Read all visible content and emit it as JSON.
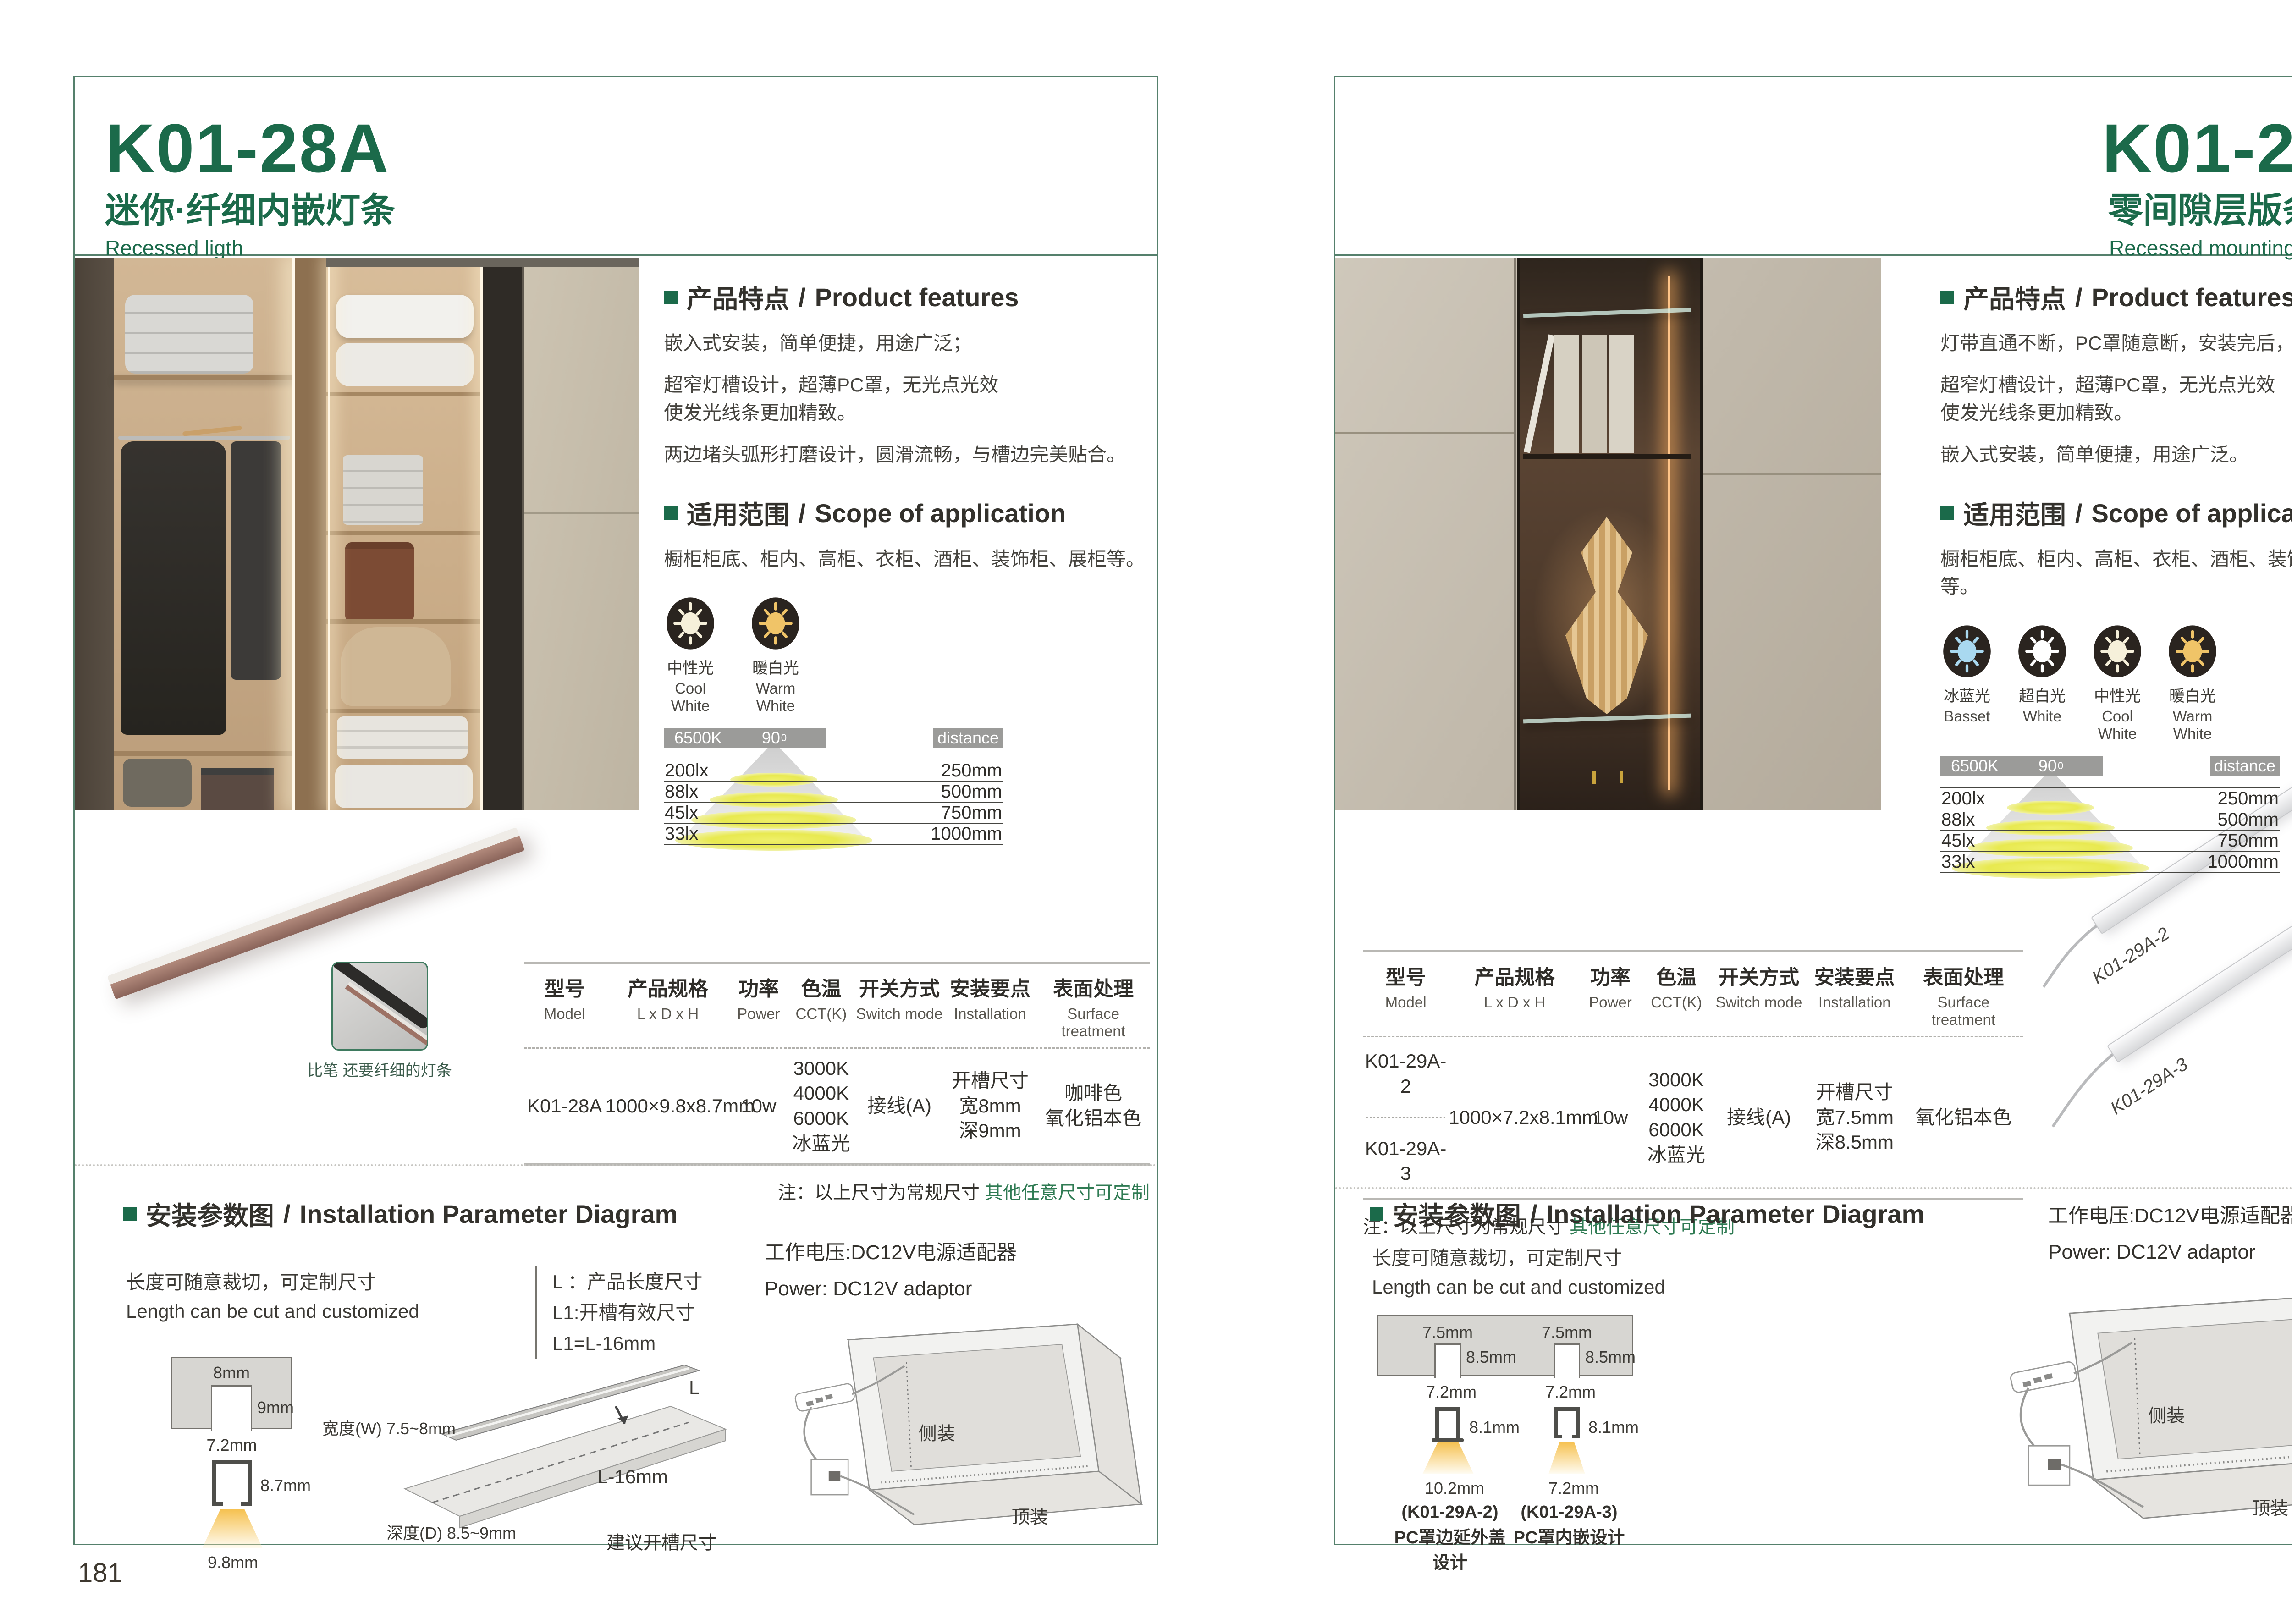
{
  "colors": {
    "accent_green": "#1b6a4a",
    "frame_green": "#55806c",
    "note_green": "#2f7b53",
    "chart_box_gray": "#9b9b99"
  },
  "left": {
    "page_number": "181",
    "header": {
      "model": "K01-28A",
      "subtitle_cn": "迷你·纤细内嵌灯条",
      "subtitle_en": "Recessed ligth"
    },
    "features": {
      "title_cn": "产品特点",
      "title_en": "Product features",
      "p1": "嵌入式安装，简单便捷，用途广泛；",
      "p2": "超窄灯槽设计，超薄PC罩，无光点光效\n使发光线条更加精致。",
      "p3": "两边堵头弧形打磨设计，圆滑流畅，与槽边完美贴合。"
    },
    "scope": {
      "title_cn": "适用范围",
      "title_en": "Scope of application",
      "text": "橱柜柜底、柜内、高柜、衣柜、酒柜、装饰柜、展柜等。"
    },
    "lights": [
      {
        "cn": "中性光",
        "en": "Cool White",
        "color": "#f6f0da"
      },
      {
        "cn": "暖白光",
        "en": "Warm White",
        "color": "#f0c468"
      }
    ],
    "photometry": {
      "cct": "6500K",
      "angle": "90",
      "angle_sup": "0",
      "distance_label": "distance",
      "rows": [
        {
          "lux": "200lx",
          "dist": "250mm"
        },
        {
          "lux": "88lx",
          "dist": "500mm"
        },
        {
          "lux": "45lx",
          "dist": "750mm"
        },
        {
          "lux": "33lx",
          "dist": "1000mm"
        }
      ]
    },
    "pen_caption": "比笔 还要纤细的灯条",
    "table": {
      "headers": [
        {
          "cn": "型号",
          "en": "Model"
        },
        {
          "cn": "产品规格",
          "en": "L x D x H"
        },
        {
          "cn": "功率",
          "en": "Power"
        },
        {
          "cn": "色温",
          "en": "CCT(K)"
        },
        {
          "cn": "开关方式",
          "en": "Switch mode"
        },
        {
          "cn": "安装要点",
          "en": "Installation"
        },
        {
          "cn": "表面处理",
          "en": "Surface treatment"
        }
      ],
      "row": {
        "model": "K01-28A",
        "spec": "1000×9.8x8.7mm",
        "power": "10w",
        "cct": "3000K\n4000K\n6000K\n冰蓝光",
        "switch": "接线(A)",
        "install": "开槽尺寸\n宽8mm\n深9mm",
        "surface": "咖啡色\n氧化铝本色"
      }
    },
    "note": {
      "label": "注：以上尺寸为常规尺寸 ",
      "highlight": "其他任意尺寸可定制"
    },
    "install": {
      "title_cn": "安装参数图",
      "title_en": "Installation Parameter Diagram",
      "cut_cn": "长度可随意裁切，可定制尺寸",
      "cut_en": "Length can be cut and customized",
      "legend_1": "L ：产品长度尺寸",
      "legend_2": "L1:开槽有效尺寸",
      "legend_3": "L1=L-16mm",
      "dims": {
        "slot_w": "8mm",
        "slot_d": "9mm",
        "body_w": "7.2mm",
        "body_h": "8.7mm",
        "beam": "9.8mm"
      },
      "board": {
        "width": "宽度(W) 7.5~8mm",
        "depth": "深度(D) 8.5~9mm",
        "length": "L",
        "cut_len": "L-16mm",
        "hint": "建议开槽尺寸"
      },
      "power_cn": "工作电压:DC12V电源适配器",
      "power_en": "Power: DC12V adaptor",
      "cabinet": {
        "side": "侧装",
        "top": "顶装"
      }
    }
  },
  "right": {
    "page_number": "182",
    "header": {
      "model": "K01-29A",
      "subtitle_cn": "零间隙层版条形灯",
      "subtitle_en": "Recessed mounting LED light"
    },
    "features": {
      "title_cn": "产品特点",
      "title_en": "Product features",
      "p1": "灯带直通不断，PC罩随意断，安装完后，再盖灯罩；",
      "p2": "超窄灯槽设计，超薄PC罩，无光点光效\n使发光线条更加精致。",
      "p3": "嵌入式安装，简单便捷，用途广泛。"
    },
    "scope": {
      "title_cn": "适用范围",
      "title_en": "Scope of application",
      "text": "橱柜柜底、柜内、高柜、衣柜、酒柜、装饰柜、展柜等。"
    },
    "lights": [
      {
        "cn": "冰蓝光",
        "en": "Basset",
        "color": "#a9d9f0"
      },
      {
        "cn": "超白光",
        "en": "White",
        "color": "#ffffff"
      },
      {
        "cn": "中性光",
        "en": "Cool White",
        "color": "#f6f0da"
      },
      {
        "cn": "暖白光",
        "en": "Warm White",
        "color": "#f0c468"
      }
    ],
    "photometry": {
      "cct": "6500K",
      "angle": "90",
      "angle_sup": "0",
      "distance_label": "distance",
      "rows": [
        {
          "lux": "200lx",
          "dist": "250mm"
        },
        {
          "lux": "88lx",
          "dist": "500mm"
        },
        {
          "lux": "45lx",
          "dist": "750mm"
        },
        {
          "lux": "33lx",
          "dist": "1000mm"
        }
      ]
    },
    "product_labels": {
      "a": "K01-29A-2",
      "b": "K01-29A-3"
    },
    "table": {
      "headers": [
        {
          "cn": "型号",
          "en": "Model"
        },
        {
          "cn": "产品规格",
          "en": "L x D x H"
        },
        {
          "cn": "功率",
          "en": "Power"
        },
        {
          "cn": "色温",
          "en": "CCT(K)"
        },
        {
          "cn": "开关方式",
          "en": "Switch mode"
        },
        {
          "cn": "安装要点",
          "en": "Installation"
        },
        {
          "cn": "表面处理",
          "en": "Surface treatment"
        }
      ],
      "row": {
        "model_a": "K01-29A-2",
        "model_b": "K01-29A-3",
        "spec": "1000×7.2x8.1mm",
        "power": "10w",
        "cct": "3000K\n4000K\n6000K\n冰蓝光",
        "switch": "接线(A)",
        "install": "开槽尺寸\n宽7.5mm\n深8.5mm",
        "surface": "氧化铝本色"
      }
    },
    "note": {
      "label": "注：以上尺寸为常规尺寸 ",
      "highlight": "其他任意尺寸可定制"
    },
    "install": {
      "title_cn": "安装参数图",
      "title_en": "Installation Parameter Diagram",
      "cut_cn": "长度可随意裁切，可定制尺寸",
      "cut_en": "Length can be cut and customized",
      "dims": {
        "slot_w": "7.5mm",
        "slot_d": "8.5mm",
        "body_w": "7.2mm",
        "body_h": "8.1mm",
        "beam_a": "10.2mm",
        "beam_b": "7.2mm"
      },
      "captions": [
        {
          "model": "(K01-29A-2)",
          "desc": "PC罩边延外盖设计"
        },
        {
          "model": "(K01-29A-3)",
          "desc": "PC罩内嵌设计"
        }
      ],
      "power_cn": "工作电压:DC12V电源适配器",
      "power_en": "Power: DC12V adaptor",
      "cabinet": {
        "side": "侧装",
        "top": "顶装"
      }
    }
  }
}
